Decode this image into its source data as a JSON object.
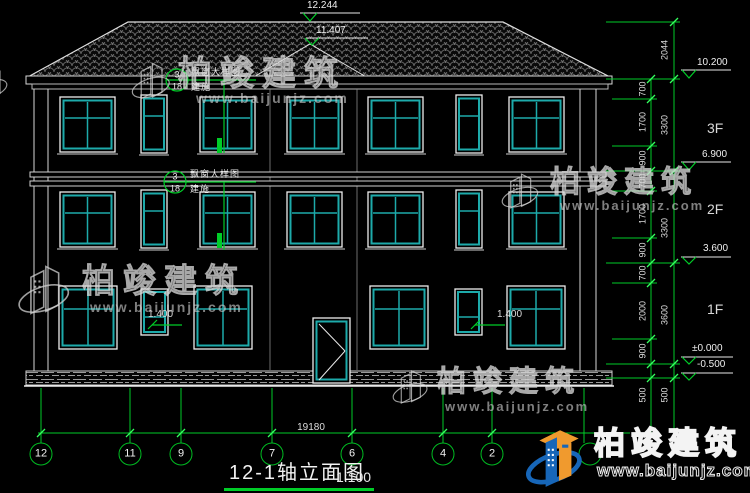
{
  "title_block": {
    "title": "12-1轴立面图",
    "scale": "1:100"
  },
  "axes": {
    "overall_dim": "19180",
    "bubbles": [
      "12",
      "11",
      "9",
      "7",
      "6",
      "4",
      "2"
    ]
  },
  "elevations": {
    "ridge": "12.244",
    "gable": "11.407",
    "eave": "10.200",
    "floor3": "6.900",
    "floor2": "3.600",
    "ground": "±0.000",
    "base": "-0.500"
  },
  "floors": [
    "3F",
    "2F",
    "1F"
  ],
  "dims": {
    "inner": [
      "700",
      "1700",
      "900",
      "700",
      "1700",
      "900",
      "700",
      "2000",
      "900",
      "500"
    ],
    "outer": [
      "2044",
      "3300",
      "3300",
      "3600",
      "500"
    ]
  },
  "annotations": {
    "sill_left": "1.400",
    "sill_right": "1.400",
    "callout_top": {
      "detail": "3",
      "sheet": "18",
      "label": "飘窗大样图",
      "ref": "建施"
    },
    "callout_mid": {
      "detail": "3",
      "sheet": "18",
      "label": "飘窗大样图",
      "ref": "建施"
    }
  },
  "watermark": {
    "brand": "柏竣建筑",
    "site": "www.baijunjz.com"
  },
  "logo": {
    "brand": "柏竣建筑",
    "site": "www.baijunjz.com"
  },
  "colors": {
    "background": "#000000",
    "line": "#e9e9e9",
    "window_teal": "#1daaaa",
    "dim_green": "#00cd28",
    "logo_blue": "#1766b8",
    "logo_orange": "#f09a2e"
  }
}
